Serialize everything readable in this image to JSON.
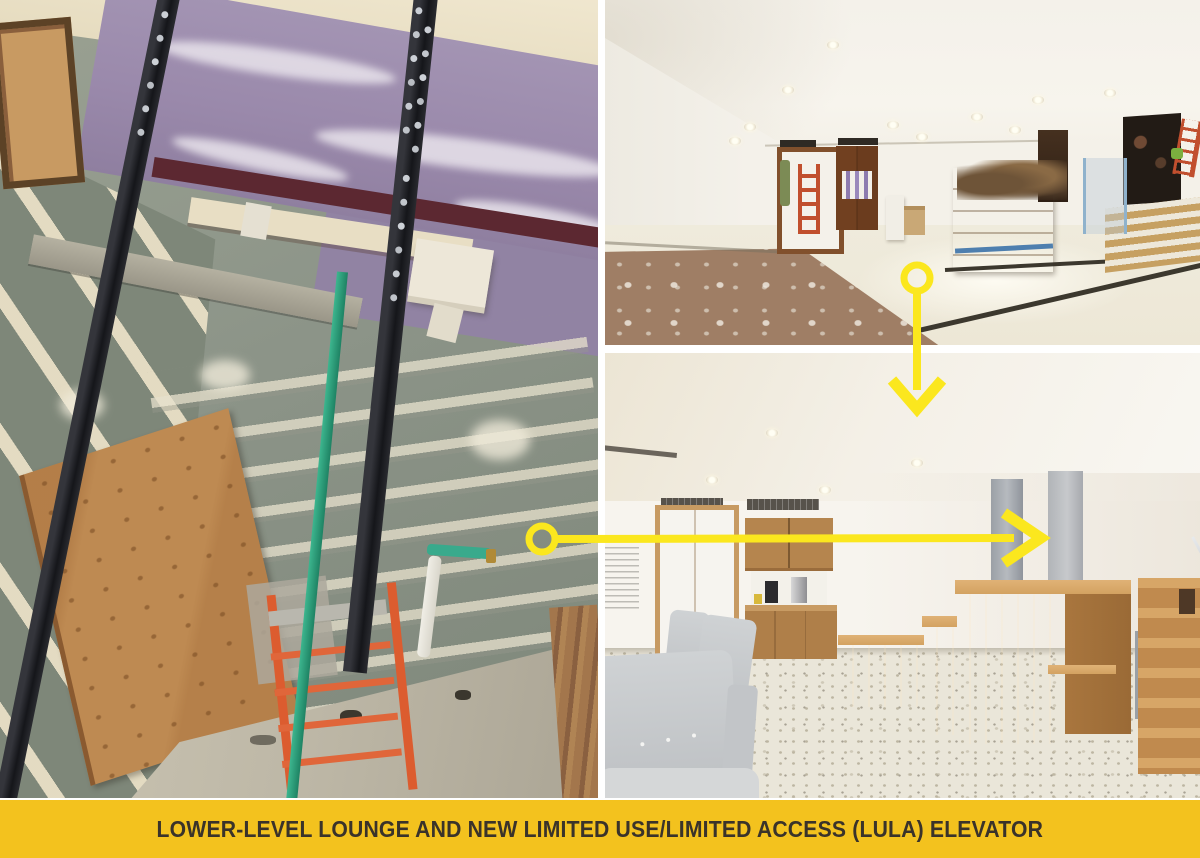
{
  "caption": {
    "text": "LOWER-LEVEL LOUNGE AND NEW LIMITED USE/LIMITED ACCESS (LULA) ELEVATOR"
  },
  "colors": {
    "background": "#FFFFFF",
    "banner": "#F3C21E",
    "banner_text": "#3A332A",
    "arrow": "#FBE71E",
    "drywall_green": "#8C9488",
    "drywall_purple": "#9A89AB",
    "rail_black": "#1F2023",
    "ladder_orange": "#DC5C2F",
    "wood": "#C18A4E"
  },
  "photos": [
    {
      "name": "elevator-shaft-photo",
      "description": "Elevator hoistway under construction with steel guide rails, plywood protection and ladder"
    },
    {
      "name": "lounge-construction-photo",
      "description": "Lower-level lounge during construction with ladders, crates and stairs"
    },
    {
      "name": "lounge-rendering-photo",
      "description": "Rendering of finished lower-level lounge with kitchenette, lounge chairs and tiered wood seating"
    }
  ]
}
